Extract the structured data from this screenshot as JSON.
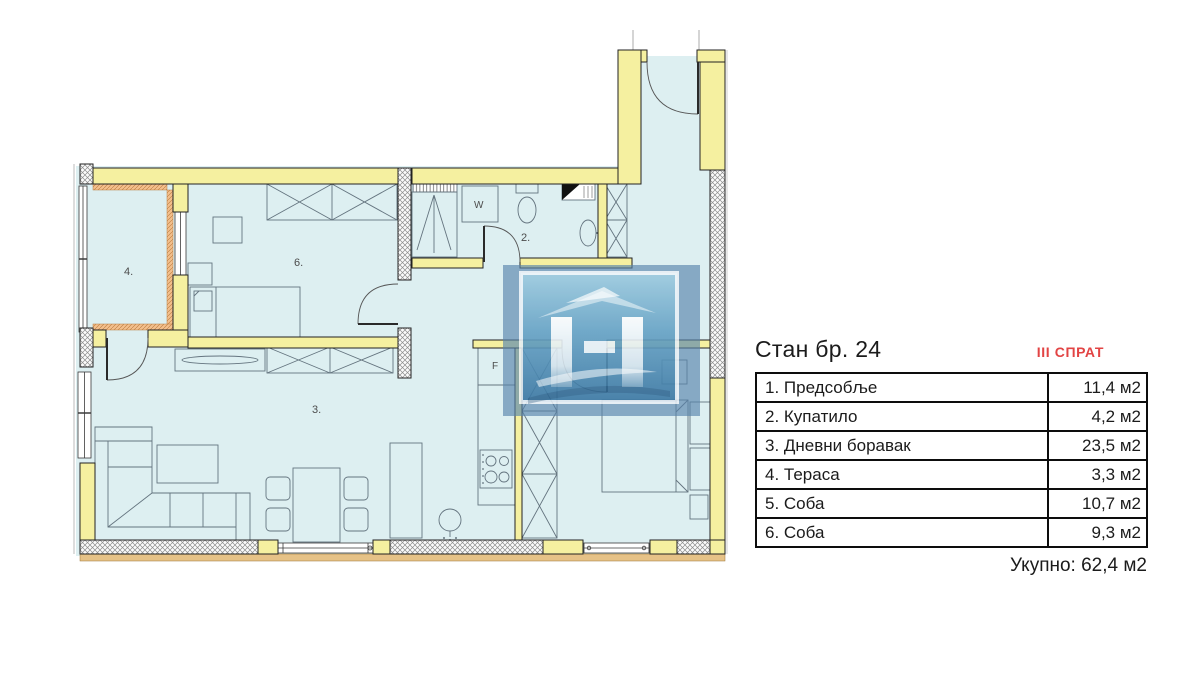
{
  "panel": {
    "title": "Стан бр. 24",
    "floor": "III СПРАТ",
    "rooms": [
      {
        "name": "1. Предсобље",
        "area": "11,4 м2"
      },
      {
        "name": "2. Купатило",
        "area": "4,2 м2"
      },
      {
        "name": "3. Дневни боравак",
        "area": "23,5 м2"
      },
      {
        "name": "4. Тераса",
        "area": "3,3 м2"
      },
      {
        "name": "5. Соба",
        "area": "10,7 м2"
      },
      {
        "name": "6. Соба",
        "area": "9,3 м2"
      }
    ],
    "total": "Укупно: 62,4 м2"
  },
  "plan": {
    "labels": {
      "terrace": "4.",
      "room6": "6.",
      "bathroom": "2.",
      "living": "3.",
      "washer": "W",
      "fridge": "F"
    }
  },
  "colors": {
    "room_fill": "#ddeff1",
    "wall_yellow": "#f5f0a0",
    "terrace_hatch": "#f3bf8d",
    "floor_red": "#e24444",
    "watermark_blue": "#5884ac"
  }
}
